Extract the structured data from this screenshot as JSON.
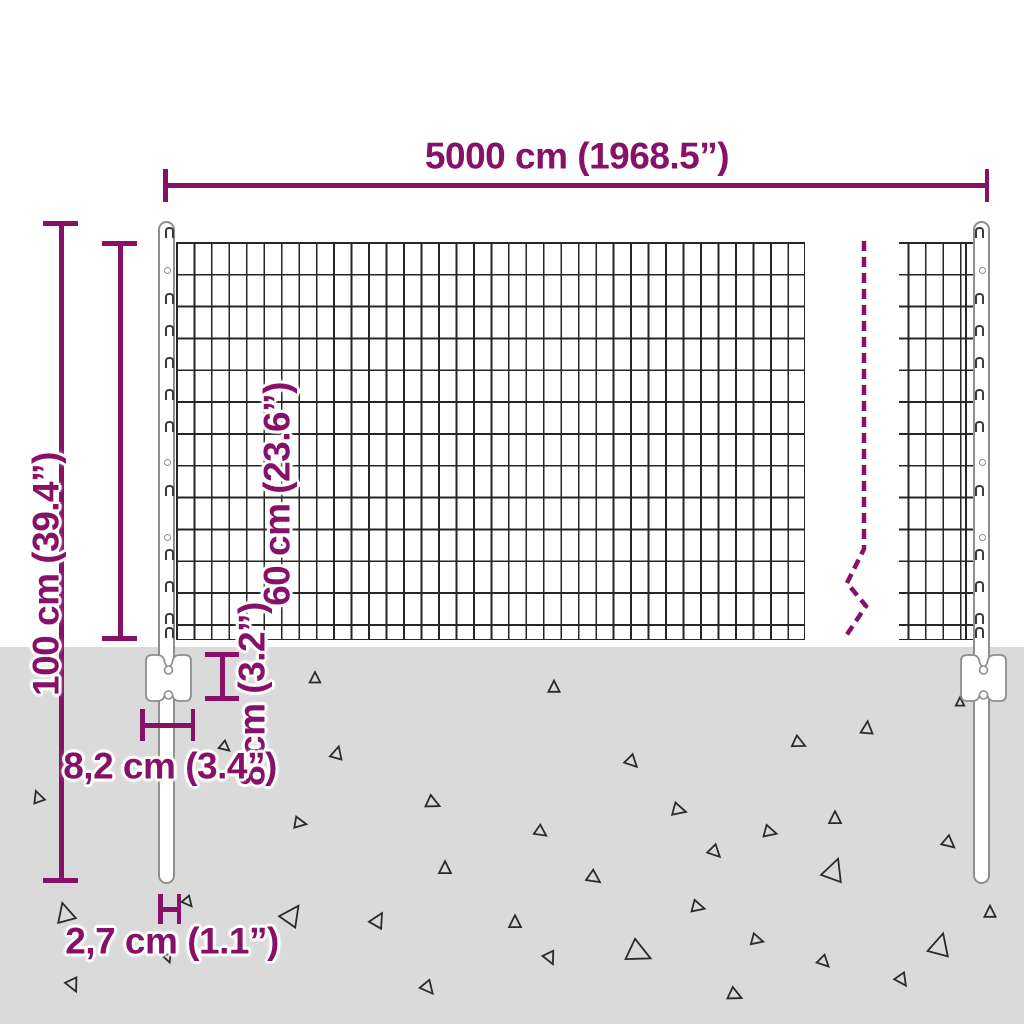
{
  "title": "Wire mesh fence panel with posts — dimension diagram",
  "colors": {
    "accent": "#871168",
    "ground": "#dadada",
    "wire": "#262626",
    "post_outline": "#8f8f8f",
    "triangle": "#2b2b2b"
  },
  "labels": {
    "width": "5000 cm (1968.5”)",
    "total_height": "100 cm (39.4”)",
    "mesh_height": "60 cm (23.6”)",
    "anchor_height": "8 cm (3.2”)",
    "anchor_width": "8,2 cm (3.4”)",
    "post_diameter": "2,7 cm (1.1”)"
  },
  "break_line": {
    "points": [
      [
        864,
        241
      ],
      [
        864,
        549
      ],
      [
        847,
        583
      ],
      [
        866,
        606
      ],
      [
        846,
        636
      ]
    ],
    "dash": "10 6",
    "stroke_width": 4.5
  },
  "posts": {
    "left_center_x": 167,
    "right_center_x": 982,
    "clip_rows": [
      236,
      302,
      334,
      366,
      398,
      430,
      494,
      558,
      590,
      622,
      636
    ],
    "hole_rows": [
      270,
      462,
      537
    ],
    "plate_hole_offsets": [
      20,
      45
    ]
  },
  "ground": {
    "top": 647,
    "triangles": [
      {
        "x": 315,
        "y": 678,
        "s": 0.75,
        "r": 0
      },
      {
        "x": 337,
        "y": 753,
        "s": 0.85,
        "r": 15
      },
      {
        "x": 38,
        "y": 797,
        "s": 0.8,
        "r": -20
      },
      {
        "x": 300,
        "y": 823,
        "s": 0.8,
        "r": 100
      },
      {
        "x": 433,
        "y": 803,
        "s": 0.9,
        "r": 115
      },
      {
        "x": 445,
        "y": 868,
        "s": 0.85,
        "r": 0
      },
      {
        "x": 65,
        "y": 913,
        "s": 1.3,
        "r": -15
      },
      {
        "x": 292,
        "y": 915,
        "s": 1.4,
        "r": 35
      },
      {
        "x": 378,
        "y": 920,
        "s": 1.0,
        "r": 30
      },
      {
        "x": 188,
        "y": 902,
        "s": 0.7,
        "r": 140
      },
      {
        "x": 73,
        "y": 985,
        "s": 0.9,
        "r": 155
      },
      {
        "x": 428,
        "y": 988,
        "s": 0.9,
        "r": 140
      },
      {
        "x": 225,
        "y": 747,
        "s": 0.7,
        "r": 130
      },
      {
        "x": 168,
        "y": 958,
        "s": 0.6,
        "r": 160
      },
      {
        "x": 554,
        "y": 687,
        "s": 0.8,
        "r": 0
      },
      {
        "x": 799,
        "y": 743,
        "s": 0.85,
        "r": 115
      },
      {
        "x": 867,
        "y": 728,
        "s": 0.85,
        "r": 5
      },
      {
        "x": 632,
        "y": 762,
        "s": 0.85,
        "r": 135
      },
      {
        "x": 679,
        "y": 810,
        "s": 0.9,
        "r": 105
      },
      {
        "x": 541,
        "y": 832,
        "s": 0.8,
        "r": 125
      },
      {
        "x": 770,
        "y": 832,
        "s": 0.85,
        "r": 105
      },
      {
        "x": 835,
        "y": 818,
        "s": 0.85,
        "r": 0
      },
      {
        "x": 715,
        "y": 852,
        "s": 0.85,
        "r": 135
      },
      {
        "x": 594,
        "y": 878,
        "s": 0.9,
        "r": 125
      },
      {
        "x": 834,
        "y": 870,
        "s": 1.5,
        "r": 20
      },
      {
        "x": 949,
        "y": 843,
        "s": 0.85,
        "r": 130
      },
      {
        "x": 698,
        "y": 907,
        "s": 0.85,
        "r": 105
      },
      {
        "x": 515,
        "y": 922,
        "s": 0.85,
        "r": 0
      },
      {
        "x": 757,
        "y": 940,
        "s": 0.8,
        "r": 105
      },
      {
        "x": 639,
        "y": 953,
        "s": 1.6,
        "r": 115
      },
      {
        "x": 550,
        "y": 958,
        "s": 0.85,
        "r": 155
      },
      {
        "x": 824,
        "y": 962,
        "s": 0.8,
        "r": 135
      },
      {
        "x": 940,
        "y": 945,
        "s": 1.5,
        "r": 15
      },
      {
        "x": 990,
        "y": 912,
        "s": 0.8,
        "r": 0
      },
      {
        "x": 902,
        "y": 980,
        "s": 0.85,
        "r": 145
      },
      {
        "x": 735,
        "y": 995,
        "s": 0.9,
        "r": 115
      },
      {
        "x": 960,
        "y": 702,
        "s": 0.6,
        "r": 0
      }
    ]
  }
}
